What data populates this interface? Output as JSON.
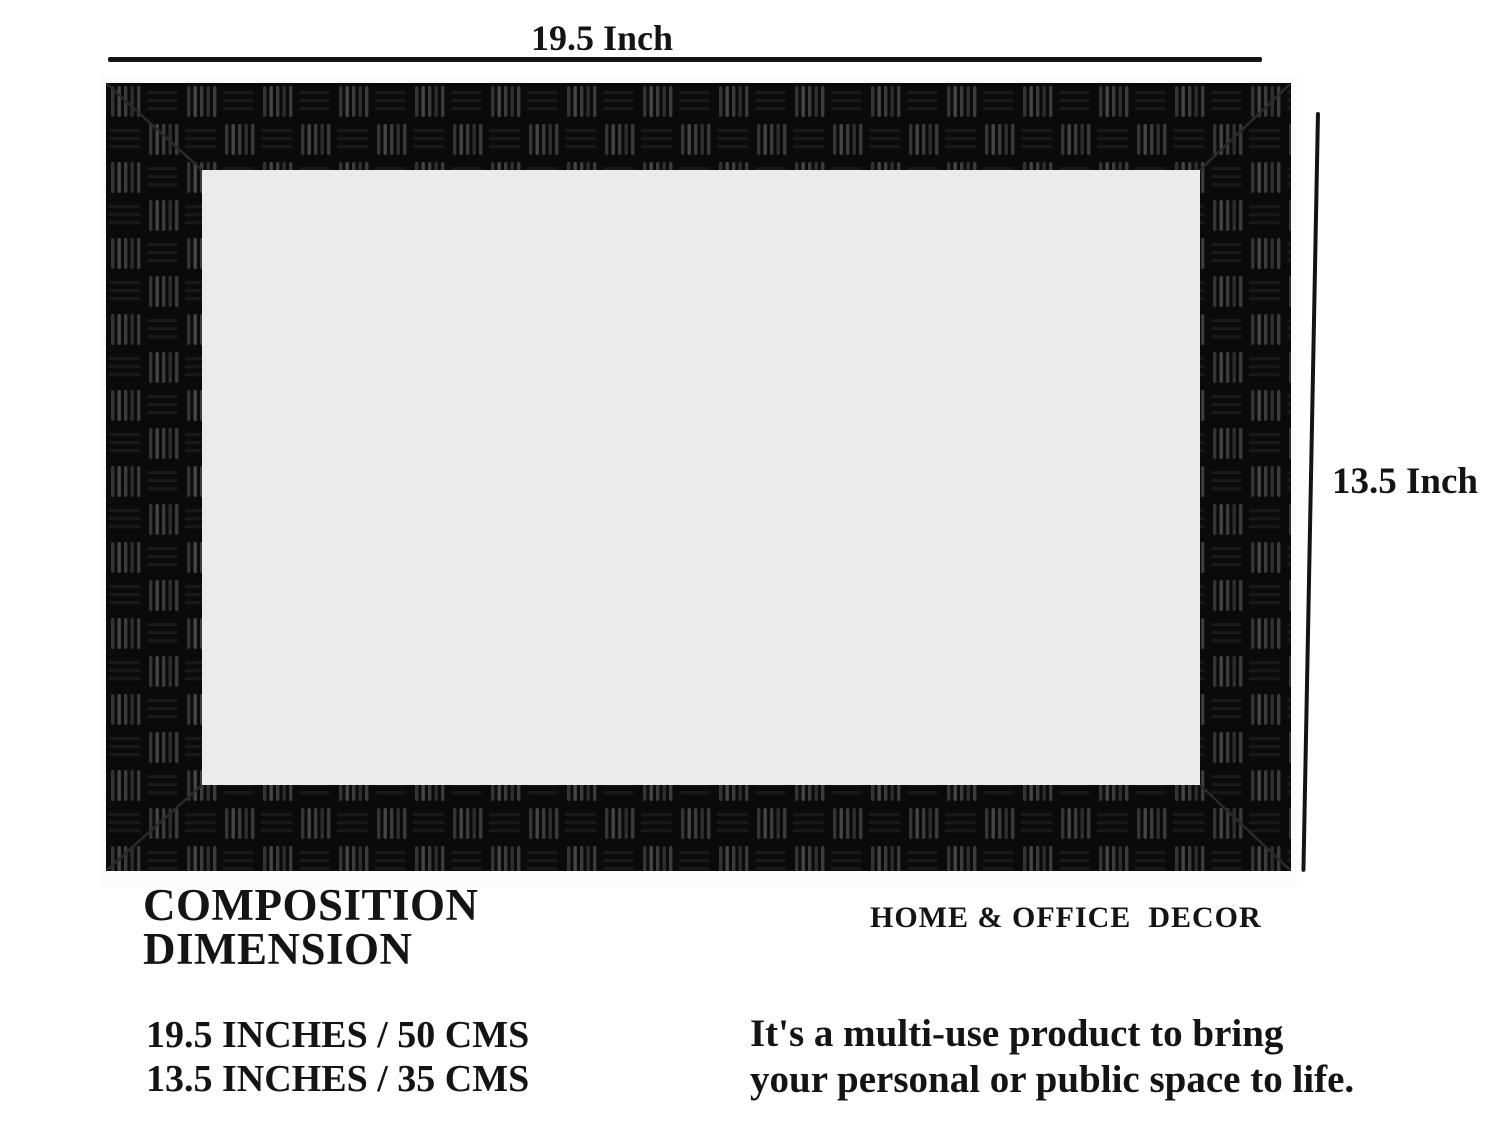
{
  "diagram": {
    "width_label": "19.5 Inch",
    "height_label": "13.5 Inch",
    "frame_base_color": "#0a0a0a",
    "weave_highlight_color": "#3b3b3b",
    "inner_panel_color": "#ebebeb",
    "dimension_line_color": "#141414"
  },
  "captions": {
    "title_line1": "COMPOSITION",
    "title_line2": "DIMENSION",
    "category": "HOME & OFFICE  DECOR",
    "size_line1": "19.5 INCHES / 50 CMS",
    "size_line2": "13.5 INCHES / 35 CMS",
    "tagline_line1": "It's a multi-use product to bring",
    "tagline_line2": "your personal or public space to life."
  }
}
